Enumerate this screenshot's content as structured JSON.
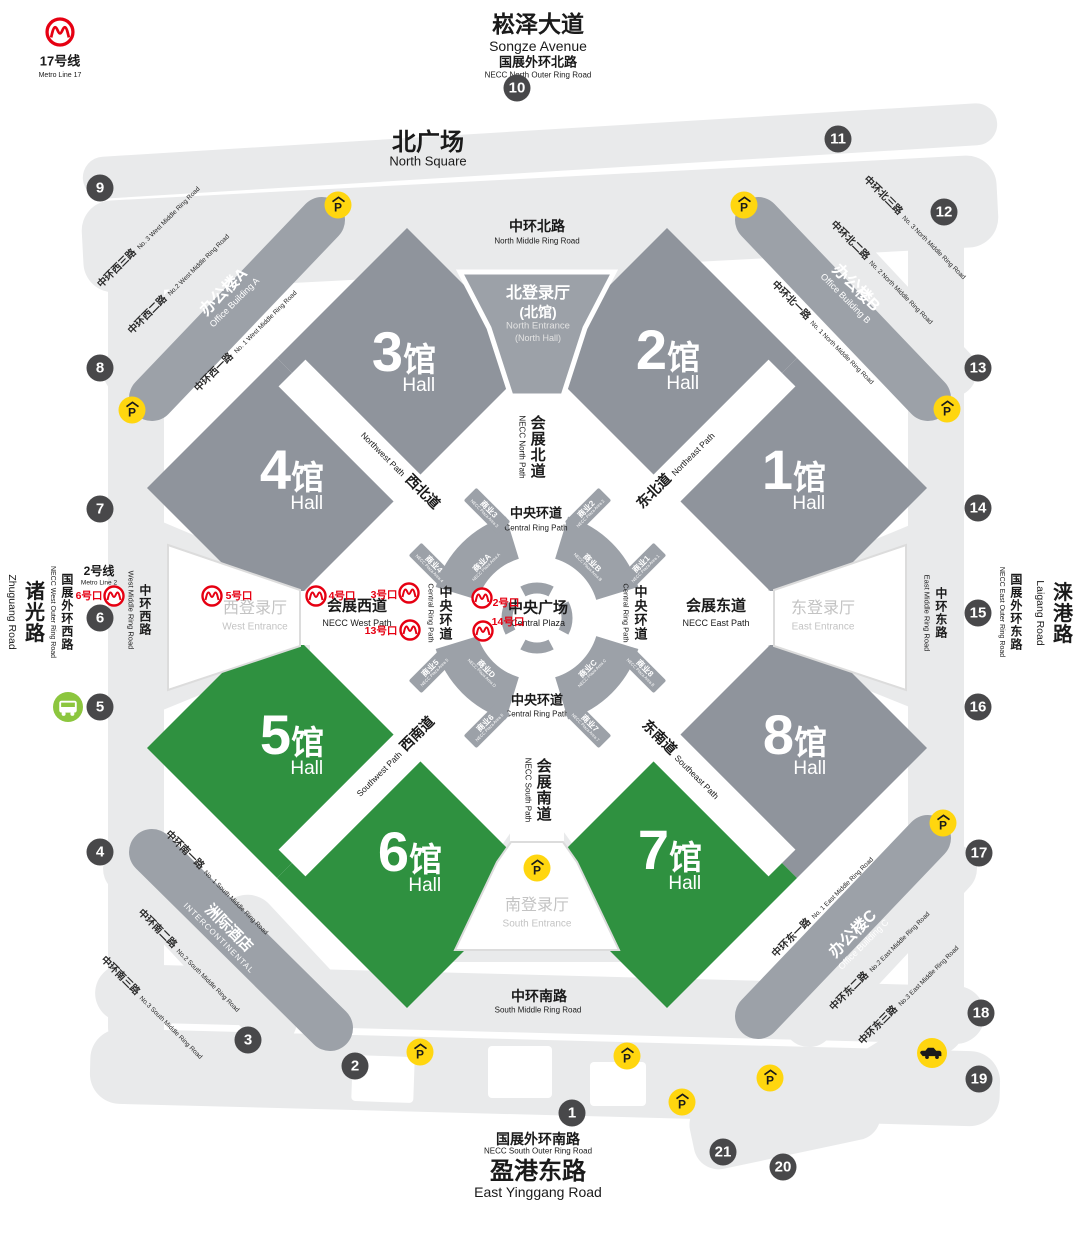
{
  "colors": {
    "hall_gray": "#8F949C",
    "hall_green": "#2F9140",
    "road_light": "#E9EAEB",
    "band_gray": "#9CA1A8",
    "accent_red": "#E60012",
    "parking_yellow": "#FFD60F",
    "marker_dark": "#48484A",
    "bus_green": "#8CC63E"
  },
  "stations": {
    "line17": {
      "name": "17号线",
      "name_en": "Metro Line 17"
    },
    "line2": {
      "name": "2号线",
      "name_en": "Metro Line 2"
    }
  },
  "top": {
    "avenue": "崧泽大道",
    "avenue_en": "Songze Avenue",
    "outer_ring": "国展外环北路",
    "outer_ring_en": "NECC North Outer Ring Road",
    "square": "北广场",
    "square_en": "North Square"
  },
  "bottom": {
    "outer_ring": "国展外环南路",
    "outer_ring_en": "NECC South Outer Ring Road",
    "road": "盈港东路",
    "road_en": "East Yinggang Road"
  },
  "sides": {
    "zhuguang": "诸光路",
    "zhuguang_en": "Zhuguang Road",
    "west_outer": "国展外环西路",
    "west_outer_en": "NECC West Outer Ring Road",
    "east_outer": "国展外环东路",
    "east_outer_en": "NECC East Outer Ring Road",
    "laigang": "涞港路",
    "laigang_en": "Laigang Road"
  },
  "ring_roads": {
    "north": {
      "zh": "中环北路",
      "en": "North Middle Ring Road"
    },
    "south": {
      "zh": "中环南路",
      "en": "South Middle Ring Road"
    },
    "west": {
      "zh": "中环西路",
      "en": "West Middle Ring Road"
    },
    "east": {
      "zh": "中环东路",
      "en": "East Middle Ring Road"
    },
    "west1": {
      "zh": "中环西一路",
      "en": "No. 1 West Middle Ring Road"
    },
    "west2": {
      "zh": "中环西二路",
      "en": "No.2 West Middle Ring Road"
    },
    "west3": {
      "zh": "中环西三路",
      "en": "No. 3 West Middle Ring Road"
    },
    "north1": {
      "zh": "中环北一路",
      "en": "No. 1 North Middle Ring Road"
    },
    "north2": {
      "zh": "中环北二路",
      "en": "No. 2 North Middle Ring Road"
    },
    "north3": {
      "zh": "中环北三路",
      "en": "No. 3 North Middle Ring Road"
    },
    "south1": {
      "zh": "中环南一路",
      "en": "No. 1 South Middle Ring Road"
    },
    "south2": {
      "zh": "中环南二路",
      "en": "No.2 South Middle Ring Road"
    },
    "south3": {
      "zh": "中环南三路",
      "en": "No.3 South Middle Ring Road"
    },
    "east1": {
      "zh": "中环东一路",
      "en": "No. 1 East Middle Ring Road"
    },
    "east2": {
      "zh": "中环东二路",
      "en": "No.2 East Middle Ring Road"
    },
    "east3": {
      "zh": "中环东三路",
      "en": "No.3 East Middle Ring Road"
    }
  },
  "buildings": {
    "office_a": {
      "zh": "办公楼A",
      "en": "Office Building A"
    },
    "office_b": {
      "zh": "办公楼B",
      "en": "Office Building B"
    },
    "office_c": {
      "zh": "办公楼C",
      "en": "Office Building C"
    },
    "hotel": {
      "zh": "洲际酒店",
      "en": "INTERCONTINENTAL"
    }
  },
  "entrances": {
    "north": {
      "zh": "北登录厅",
      "zh2": "(北馆)",
      "en": "North Entrance",
      "en2": "(North Hall)"
    },
    "west": {
      "zh": "西登录厅",
      "en": "West Entrance"
    },
    "east": {
      "zh": "东登录厅",
      "en": "East Entrance"
    },
    "south": {
      "zh": "南登录厅",
      "en": "South Entrance"
    }
  },
  "paths": {
    "necc_north": {
      "zh": "会展北道",
      "en": "NECC North Path"
    },
    "necc_south": {
      "zh": "会展南道",
      "en": "NECC South Path"
    },
    "necc_west": {
      "zh": "会展西道",
      "en": "NECC West Path"
    },
    "necc_east": {
      "zh": "会展东道",
      "en": "NECC East Path"
    },
    "northwest": {
      "zh": "西北道",
      "en": "Northwest Path"
    },
    "northeast": {
      "zh": "东北道",
      "en": "Northeast Path"
    },
    "southwest": {
      "zh": "西南道",
      "en": "Southwest Path"
    },
    "southeast": {
      "zh": "东南道",
      "en": "Southeast Path"
    },
    "central_ring": {
      "zh": "中央环道",
      "en": "Central Ring Path"
    },
    "central_plaza": {
      "zh": "中央广场",
      "en": "Central Plaza"
    }
  },
  "halls": [
    {
      "num": "3",
      "suffix": "馆",
      "en": "Hall"
    },
    {
      "num": "2",
      "suffix": "馆",
      "en": "Hall"
    },
    {
      "num": "4",
      "suffix": "馆",
      "en": "Hall"
    },
    {
      "num": "1",
      "suffix": "馆",
      "en": "Hall"
    },
    {
      "num": "5",
      "suffix": "馆",
      "en": "Hall"
    },
    {
      "num": "8",
      "suffix": "馆",
      "en": "Hall"
    },
    {
      "num": "6",
      "suffix": "馆",
      "en": "Hall"
    },
    {
      "num": "7",
      "suffix": "馆",
      "en": "Hall"
    }
  ],
  "plaza_units": {
    "arcs": [
      {
        "zh": "商业A",
        "en": "NECC Plaza Area A"
      },
      {
        "zh": "商业B",
        "en": "NECC Plaza Area B"
      },
      {
        "zh": "商业C",
        "en": "NECC Plaza Area C"
      },
      {
        "zh": "商业D",
        "en": "NECC Plaza Area D"
      }
    ],
    "wedges": [
      {
        "zh": "商业1",
        "en": "NECC Plaza Area 1"
      },
      {
        "zh": "商业2",
        "en": "NECC Plaza Area 2"
      },
      {
        "zh": "商业3",
        "en": "NECC Plaza Area 3"
      },
      {
        "zh": "商业4",
        "en": "NECC Plaza Area 4"
      },
      {
        "zh": "商业5",
        "en": "NECC Plaza Area 5"
      },
      {
        "zh": "商业6",
        "en": "NECC Plaza Area 6"
      },
      {
        "zh": "商业7",
        "en": "NECC Plaza Area 7"
      },
      {
        "zh": "商业8",
        "en": "NECC Plaza Area 8"
      }
    ]
  },
  "metro_exits": [
    {
      "label": "6号口"
    },
    {
      "label": "5号口"
    },
    {
      "label": "4号口"
    },
    {
      "label": "3号口"
    },
    {
      "label": "13号口"
    },
    {
      "label": "2号口"
    },
    {
      "label": "14号口"
    }
  ],
  "markers": [
    "1",
    "2",
    "3",
    "4",
    "5",
    "6",
    "7",
    "8",
    "9",
    "10",
    "11",
    "12",
    "13",
    "14",
    "15",
    "16",
    "17",
    "18",
    "19",
    "20",
    "21"
  ],
  "icons": {
    "parking": "P"
  }
}
